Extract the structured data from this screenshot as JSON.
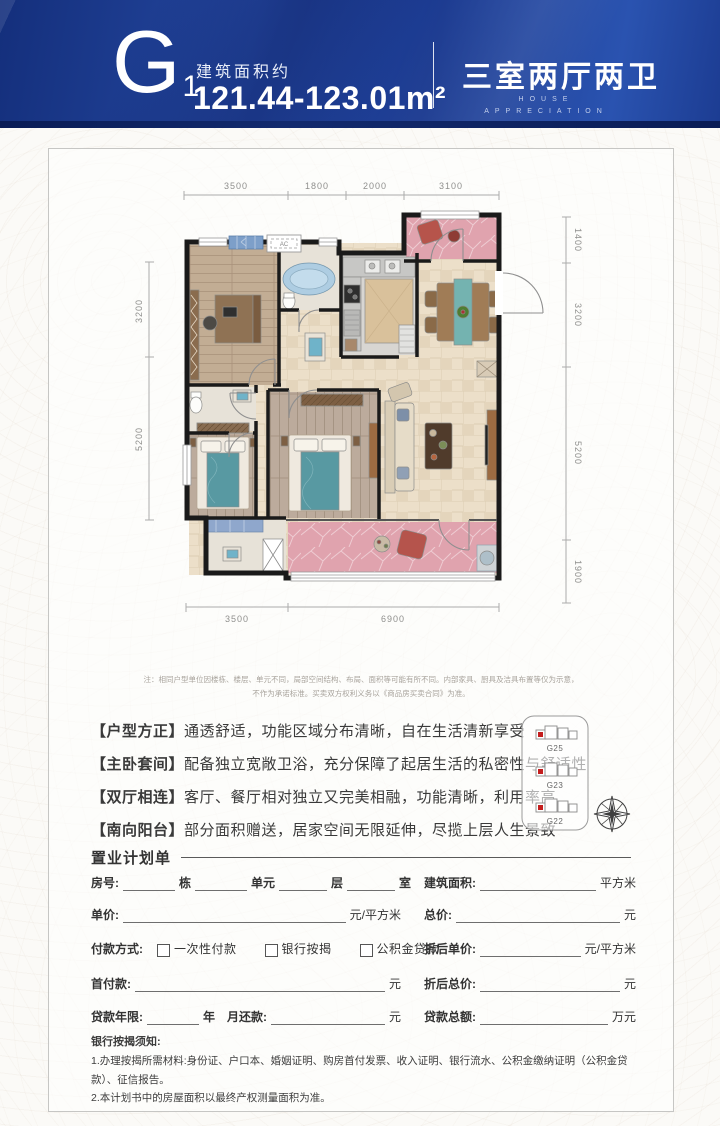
{
  "header": {
    "unit_code": "G",
    "unit_code_sub": "1",
    "area_label": "建筑面积约",
    "area_value": "121.44-123.01m²",
    "layout": "三室两厅两卫",
    "subtitle_en_1": "HOUSE",
    "subtitle_en_2": "APPRECIATION"
  },
  "palette": {
    "header_blue": "#1d3e95",
    "floor_pink": "#e2a4af",
    "bed_teal": "#579aa3",
    "marker_red": "#c41e1e"
  },
  "floorplan": {
    "dims_top": [
      "3500",
      "1800",
      "2000",
      "3100"
    ],
    "dims_bottom": [
      "3500",
      "6900"
    ],
    "dims_left": [
      "3200",
      "5200"
    ],
    "dims_right": [
      "1400",
      "3200",
      "5200",
      "1900"
    ],
    "ac_label": "AC",
    "note_line1": "注：相同户型单位因楼栋、楼层、单元不同，局部空间结构、布局、面积等可能有所不同。内部家具、厨具及洁具布置等仅为示意，",
    "note_line2": "不作为承诺标准。买卖双方权利义务以《商品房买卖合同》为准。"
  },
  "features": [
    {
      "tag": "【户型方正】",
      "desc": "通透舒适，功能区域分布清晰，自在生活清新享受"
    },
    {
      "tag": "【主卧套间】",
      "desc": "配备独立宽敞卫浴，充分保障了起居生活的私密性与舒适性"
    },
    {
      "tag": "【双厅相连】",
      "desc": "客厅、餐厅相对独立又完美相融，功能清晰，利用率高"
    },
    {
      "tag": "【南向阳台】",
      "desc": "部分面积赠送，居家空间无限延伸，尽揽上层人生景致"
    }
  ],
  "site_map": {
    "buildings": [
      {
        "label": "G25"
      },
      {
        "label": "G23"
      },
      {
        "label": "G22"
      }
    ]
  },
  "form": {
    "title": "置业计划单",
    "room_label": "房号:",
    "room_units": [
      "栋",
      "单元",
      "层",
      "室"
    ],
    "area_label": "建筑面积:",
    "area_unit": "平方米",
    "price_label": "单价:",
    "price_unit": "元/平方米",
    "total_label": "总价:",
    "total_unit": "元",
    "pay_label": "付款方式:",
    "pay_options": [
      "一次性付款",
      "银行按揭",
      "公积金贷款"
    ],
    "disc_price_label": "折后单价:",
    "disc_price_unit": "元/平方米",
    "down_label": "首付款:",
    "down_unit": "元",
    "disc_total_label": "折后总价:",
    "disc_total_unit": "元",
    "loan_years_label": "贷款年限:",
    "loan_years_unit": "年",
    "monthly_label": "月还款:",
    "monthly_unit": "元",
    "loan_total_label": "贷款总额:",
    "loan_total_unit": "万元"
  },
  "bank_notice": {
    "title": "银行按揭须知:",
    "items": [
      "1.办理按揭所需材料:身份证、户口本、婚姻证明、购房首付发票、收入证明、银行流水、公积金缴纳证明（公积金贷款）、征信报告。",
      "2.本计划书中的房屋面积以最终产权测量面积为准。"
    ]
  }
}
